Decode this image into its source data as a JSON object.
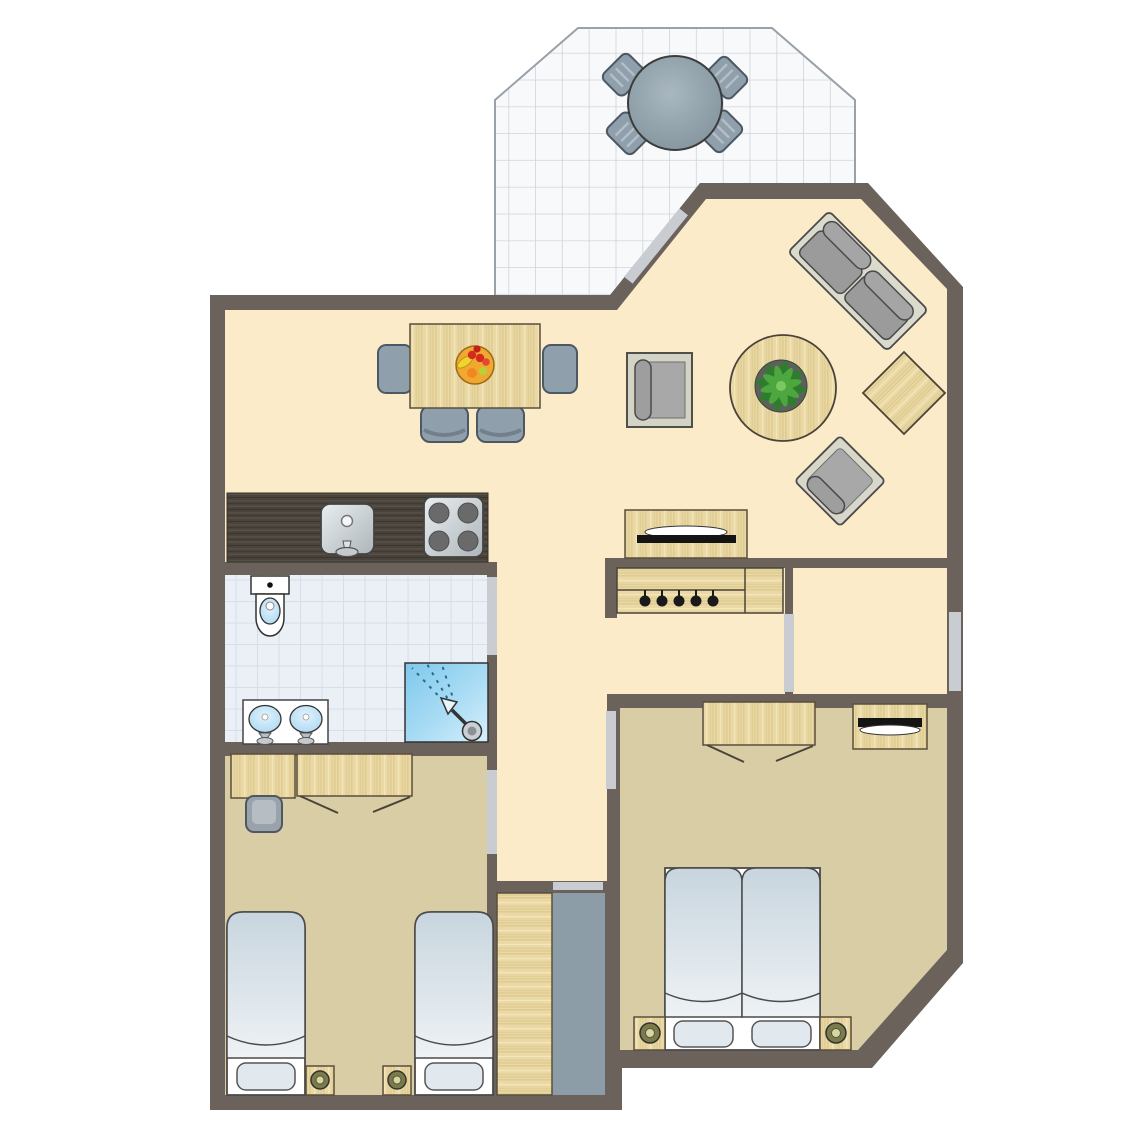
{
  "plan": {
    "kind": "apartment-floor-plan",
    "rooms": [
      {
        "id": "terrace",
        "label": "terrace",
        "furniture": [
          "round-table",
          "terrace-chair x4"
        ]
      },
      {
        "id": "living-room",
        "label": "living room",
        "furniture": [
          "dining-table",
          "dining-chair x4",
          "fruit-bowl",
          "reading-armchair",
          "coffee-table",
          "potted-plant",
          "sofa",
          "side-table",
          "lounge-chair",
          "tv-sideboard"
        ]
      },
      {
        "id": "kitchen",
        "label": "kitchen",
        "furniture": [
          "counter",
          "sink",
          "stove-4-burners"
        ]
      },
      {
        "id": "hallway",
        "label": "hallway",
        "furniture": [
          "coat-rack-5-hooks"
        ]
      },
      {
        "id": "entry-room",
        "label": "entry room",
        "furniture": []
      },
      {
        "id": "bathroom",
        "label": "bathroom",
        "furniture": [
          "toilet",
          "double-vanity",
          "shower"
        ]
      },
      {
        "id": "bedroom-left",
        "label": "left bedroom",
        "furniture": [
          "desk",
          "desk-chair",
          "wardrobe",
          "single-bed x2",
          "nightstand-lamp x2"
        ]
      },
      {
        "id": "bedroom-right",
        "label": "right bedroom",
        "furniture": [
          "wardrobe",
          "tv-dresser",
          "double-bed",
          "nightstand-lamp x2"
        ]
      },
      {
        "id": "closet",
        "label": "storage closet",
        "furniture": [
          "wardrobe"
        ]
      }
    ],
    "openings": [
      {
        "id": "window-diagonal",
        "type": "window",
        "wall": "living-room-diagonal"
      },
      {
        "id": "entry-door",
        "type": "door",
        "wall": "right-exterior"
      },
      {
        "id": "entry-room-door",
        "type": "door",
        "wall": "entry-room-left"
      },
      {
        "id": "bathroom-door",
        "type": "door",
        "wall": "hall-left"
      },
      {
        "id": "bedroom-left-door",
        "type": "door",
        "wall": "hall-left"
      },
      {
        "id": "bedroom-right-door",
        "type": "door",
        "wall": "hall-right"
      },
      {
        "id": "closet-opening",
        "type": "opening",
        "wall": "hall-bottom"
      }
    ],
    "counts": {
      "coat_hooks": 5,
      "stove_burners": 4,
      "dining_chairs": 4,
      "terrace_chairs": 4,
      "single_beds": 2,
      "double_bed_mattresses": 2
    }
  },
  "colors": {
    "wall": "#6A625B",
    "living_floor": "#FCEBC9",
    "bedroom_floor": "#D8CDA5",
    "closet_floor": "#8C9DA8",
    "bath_tile": "#EAF0F6",
    "bath_tile_line": "#D4DDE7",
    "terrace_tile": "#F8F9FB",
    "terrace_tile_line": "#CFD5DB",
    "terrace_outline": "#99A1A9",
    "door_marker": "#C9CDD1",
    "wood": "#EBD9A5",
    "wood_grain": "#E0CD96",
    "wood_stroke": "#5A4E3C",
    "counter_dark": "#4A433B",
    "counter_grain": "#5A5248",
    "chair_blue": "#8FA0AC",
    "chair_stroke": "#4C5964",
    "sofa_frame": "#DADBCC",
    "cushion_gray": "#9B9B9B",
    "furn_stroke": "#4A4A4A",
    "bed_top": "#C8D5DE",
    "bed_bottom": "#EEF2F5",
    "pillow": "#E2E9EE",
    "water_blue": "#A9D7F2",
    "shower_blue": "#7EC8EC",
    "shower_blue_light": "#D6F0FB",
    "metal_light": "#E9EDEF",
    "metal_dark": "#ADB6BB",
    "tv_black": "#141414",
    "plant_dark": "#2E7D2E",
    "plant_light": "#4CA83E",
    "pot_gray": "#5A6158",
    "lamp_ring": "#7A7A4A",
    "lamp_center": "#D6D6A0",
    "fruit_bowl": "#F0A830",
    "berry_red": "#D42B20",
    "table_gray": "#8FA0AA"
  }
}
